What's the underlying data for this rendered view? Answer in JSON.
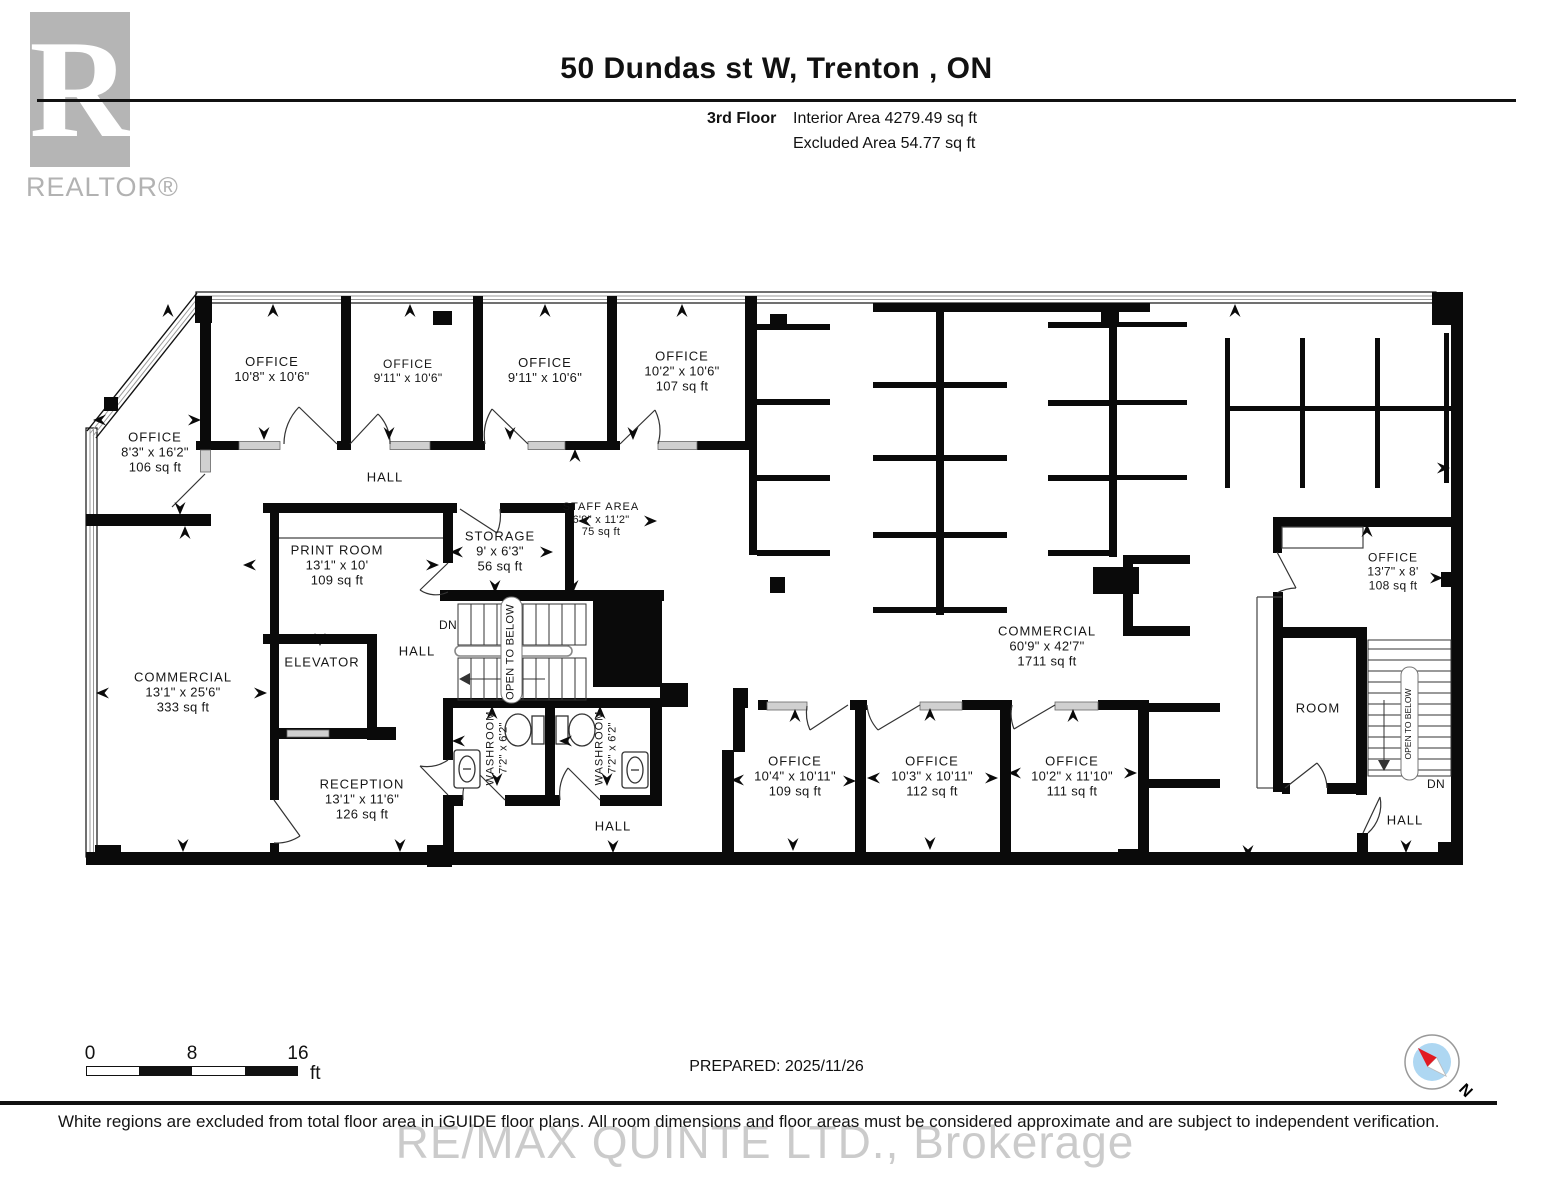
{
  "header": {
    "logo_letter": "R",
    "logo_word": "REALTOR®",
    "title": "50 Dundas st W, Trenton , ON",
    "floor_label": "3rd Floor",
    "interior_area": "Interior Area 4279.49 sq ft",
    "excluded_area": "Excluded Area 54.77 sq ft"
  },
  "rooms": {
    "office_corner": {
      "name": "OFFICE",
      "dims": "8'3\" x 16'2\"",
      "area": "106 sq ft"
    },
    "office_t1": {
      "name": "OFFICE",
      "dims": "10'8\" x 10'6\""
    },
    "office_t2": {
      "name": "OFFICE",
      "dims": "9'11\" x 10'6\""
    },
    "office_t3": {
      "name": "OFFICE",
      "dims": "9'11\" x 10'6\""
    },
    "office_t4": {
      "name": "OFFICE",
      "dims": "10'2\" x 10'6\"",
      "area": "107 sq ft"
    },
    "print_room": {
      "name": "PRINT ROOM",
      "dims": "13'1\" x 10'",
      "area": "109 sq ft"
    },
    "storage": {
      "name": "STORAGE",
      "dims": "9' x 6'3\"",
      "area": "56 sq ft"
    },
    "staff_area": {
      "name": "STAFF AREA",
      "dims": "6'9\" x 11'2\"",
      "area": "75 sq ft"
    },
    "commercial_left": {
      "name": "COMMERCIAL",
      "dims": "13'1\" x 25'6\"",
      "area": "333 sq ft"
    },
    "reception": {
      "name": "RECEPTION",
      "dims": "13'1\" x 11'6\"",
      "area": "126 sq ft"
    },
    "washroom": {
      "name": "WASHROOM",
      "dims": "7'2\" x 6'2\""
    },
    "office_b1": {
      "name": "OFFICE",
      "dims": "10'4\" x 10'11\"",
      "area": "109 sq ft"
    },
    "office_b2": {
      "name": "OFFICE",
      "dims": "10'3\" x 10'11\"",
      "area": "112 sq ft"
    },
    "office_b3": {
      "name": "OFFICE",
      "dims": "10'2\" x 11'10\"",
      "area": "111 sq ft"
    },
    "commercial_main": {
      "name": "COMMERCIAL",
      "dims": "60'9\" x 42'7\"",
      "area": "1711 sq ft"
    },
    "office_right": {
      "name": "OFFICE",
      "dims": "13'7\" x 8'",
      "area": "108 sq ft"
    },
    "room": {
      "name": "ROOM"
    },
    "elevator": {
      "name": "ELEVATOR"
    }
  },
  "labels": {
    "hall": "HALL",
    "dn": "DN",
    "open_to_below": "OPEN TO BELOW"
  },
  "scale_bar": {
    "tick0": "0",
    "tick8": "8",
    "tick16": "16",
    "unit": "ft"
  },
  "footer": {
    "prepared": "PREPARED: 2025/11/26",
    "disclaimer": "White regions are excluded from total floor area in iGUIDE floor plans. All room dimensions and floor areas must be considered approximate and are subject to independent verification.",
    "watermark": "RE/MAX QUINTE LTD., Brokerage",
    "compass_north": "N"
  },
  "colors": {
    "wall": "#0a0a0a",
    "sill": "#d0d0d0",
    "compass_inner": "#aed7f2",
    "needle_red": "#e11b22"
  }
}
